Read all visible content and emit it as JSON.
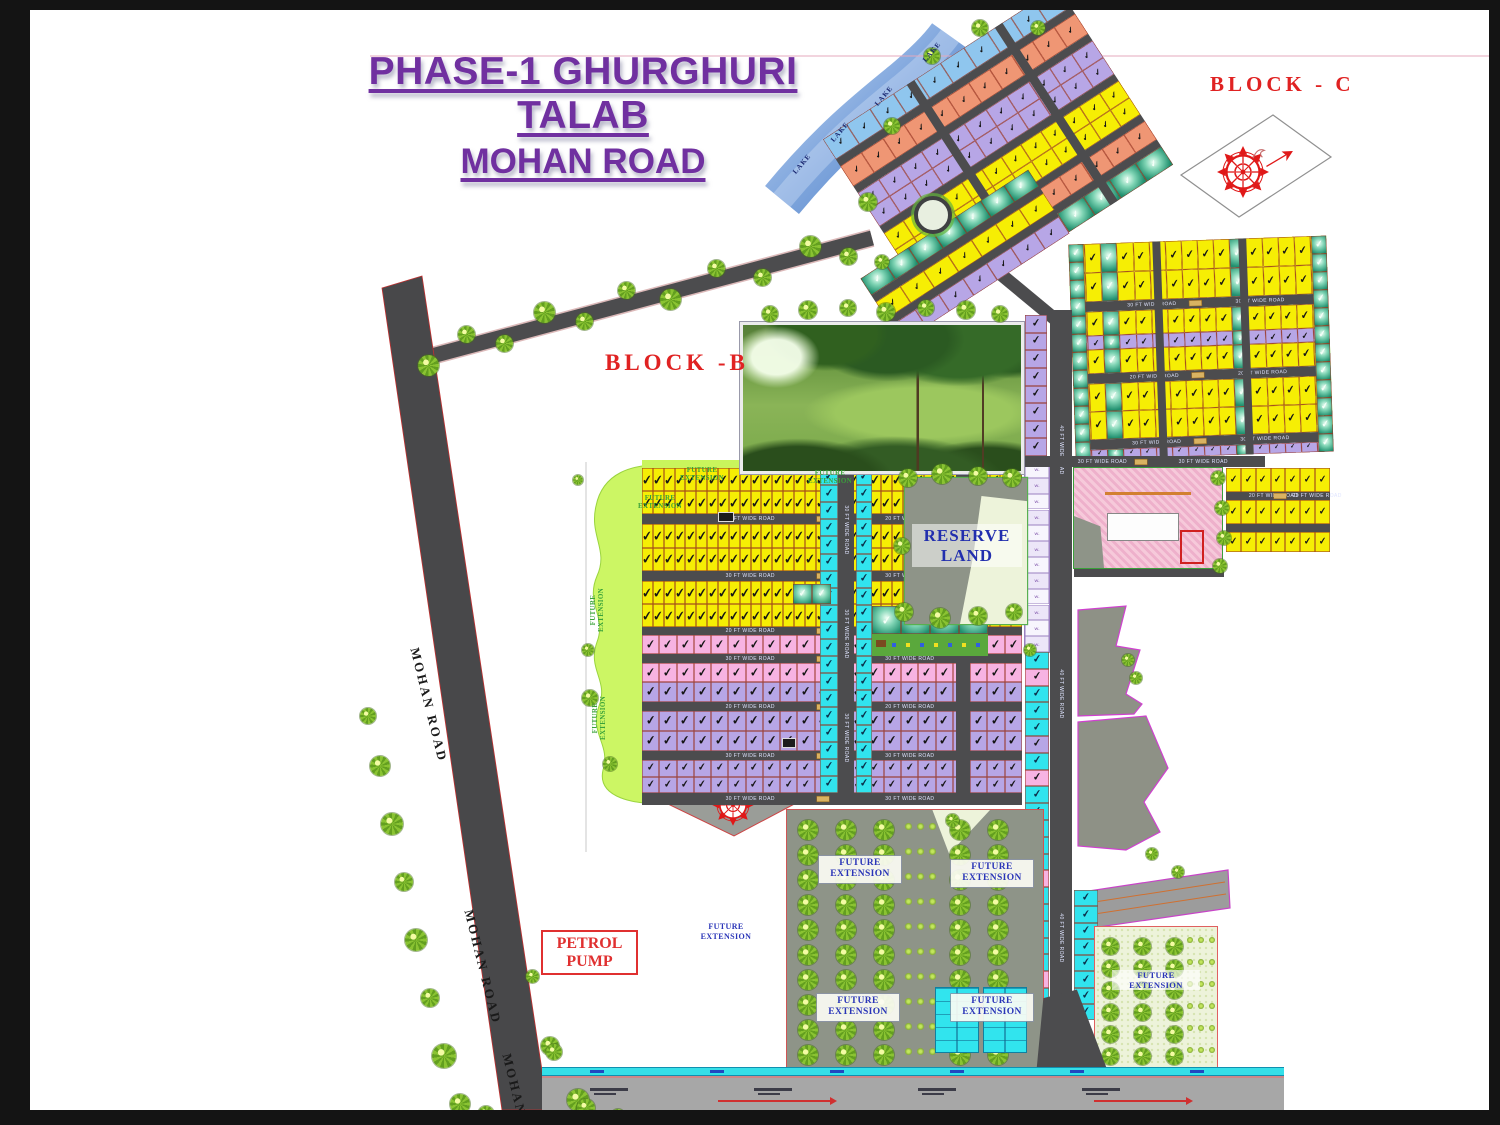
{
  "title": {
    "line1": "PHASE-1 GHURGHURI TALAB",
    "line2": "MOHAN ROAD"
  },
  "labels": {
    "block_c": "BLOCK - C",
    "block_b": "BLOCK -B",
    "reserve_land": "RESERVE LAND",
    "petrol_line1": "PETROL",
    "petrol_line2": "PUMP",
    "future_extension": "FUTURE EXTENSION",
    "mohan_road": "MOHAN ROAD",
    "lake": "LAKE",
    "w_prefix": "W-"
  },
  "road_captions": {
    "r20": "20 FT WIDE ROAD",
    "r30": "30 FT WIDE ROAD",
    "r40": "40 FT WIDE ROAD"
  },
  "glyphs": {
    "check": "✔"
  },
  "palette": {
    "title": "#7030a0",
    "red_label": "#e02222",
    "blue_label": "#2a35b8",
    "green_label": "#3aa23a",
    "plot_yellow": "#f6ee04",
    "plot_cyan": "#31e4ee",
    "plot_purple": "#b7a6e6",
    "plot_pink": "#f7b3e2",
    "plot_orange": "#ef9674",
    "plot_blue": "#8fc6ee",
    "park_teal": "#1f8f6e",
    "road_dark": "#4c4c4e",
    "road_light": "#a7a7a7",
    "lake_blue": "#6f9ad8",
    "future_blob": "#c9f55c",
    "gray_land": "#8e9488",
    "pale_land": "#edf3da",
    "check_dark": "#161616"
  }
}
